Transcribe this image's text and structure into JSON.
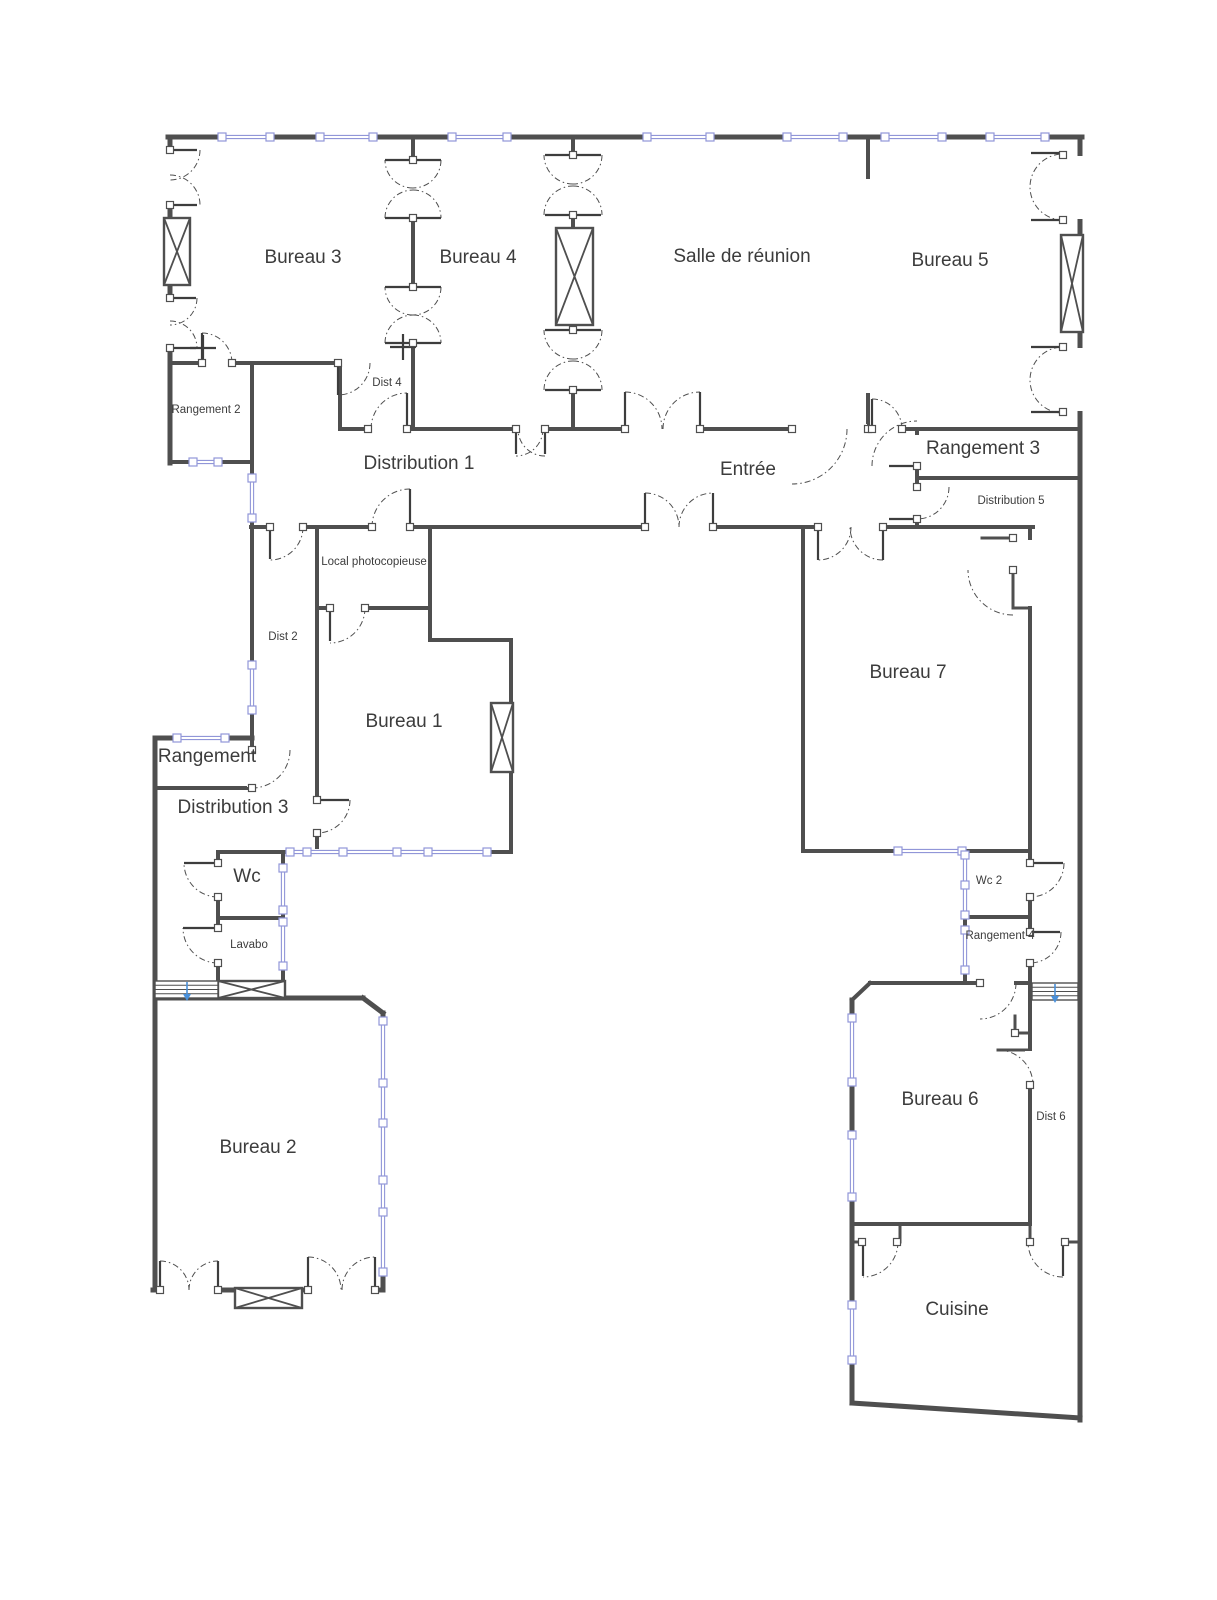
{
  "title": "Plan d'étage bureaux",
  "colors": {
    "background": "#ffffff",
    "wall": "#4f4f4f",
    "wall_thin": "#5a5a5a",
    "window": "#9196d8",
    "window_fill": "#ffffff",
    "door": "#4f4f4f",
    "label": "#3c3c3c",
    "stair_arrow": "#4a90d9"
  },
  "rooms": [
    {
      "id": "bureau-3",
      "label": "Bureau 3",
      "x": 303,
      "y": 258,
      "size": 19
    },
    {
      "id": "bureau-4",
      "label": "Bureau 4",
      "x": 478,
      "y": 258,
      "size": 19
    },
    {
      "id": "salle-de-reunion",
      "label": "Salle de réunion",
      "x": 742,
      "y": 257,
      "size": 19
    },
    {
      "id": "bureau-5",
      "label": "Bureau 5",
      "x": 950,
      "y": 261,
      "size": 19
    },
    {
      "id": "rangement-2",
      "label": "Rangement 2",
      "x": 206,
      "y": 410,
      "size": 11.5
    },
    {
      "id": "dist-4",
      "label": "Dist 4",
      "x": 387,
      "y": 383,
      "size": 11.5
    },
    {
      "id": "distribution-1",
      "label": "Distribution 1",
      "x": 419,
      "y": 464,
      "size": 19
    },
    {
      "id": "entree",
      "label": "Entrée",
      "x": 748,
      "y": 470,
      "size": 19
    },
    {
      "id": "rangement-3",
      "label": "Rangement 3",
      "x": 983,
      "y": 449,
      "size": 19
    },
    {
      "id": "distribution-5",
      "label": "Distribution 5",
      "x": 1011,
      "y": 501,
      "size": 11.5
    },
    {
      "id": "local-photocopieuse",
      "label": "Local photocopieuse",
      "x": 374,
      "y": 562,
      "size": 11.5
    },
    {
      "id": "dist-2",
      "label": "Dist 2",
      "x": 283,
      "y": 637,
      "size": 11.5
    },
    {
      "id": "bureau-1",
      "label": "Bureau 1",
      "x": 404,
      "y": 722,
      "size": 19
    },
    {
      "id": "bureau-7",
      "label": "Bureau 7",
      "x": 908,
      "y": 673,
      "size": 19
    },
    {
      "id": "rangement",
      "label": "Rangement",
      "x": 207,
      "y": 757,
      "size": 19
    },
    {
      "id": "distribution-3",
      "label": "Distribution 3",
      "x": 233,
      "y": 808,
      "size": 19
    },
    {
      "id": "wc",
      "label": "Wc",
      "x": 247,
      "y": 877,
      "size": 19
    },
    {
      "id": "lavabo",
      "label": "Lavabo",
      "x": 249,
      "y": 945,
      "size": 11.5
    },
    {
      "id": "wc-2",
      "label": "Wc 2",
      "x": 989,
      "y": 881,
      "size": 11.5
    },
    {
      "id": "rangement-4",
      "label": "Rangement 4",
      "x": 1000,
      "y": 936,
      "size": 11.5
    },
    {
      "id": "bureau-2",
      "label": "Bureau 2",
      "x": 258,
      "y": 1148,
      "size": 19
    },
    {
      "id": "bureau-6",
      "label": "Bureau 6",
      "x": 940,
      "y": 1100,
      "size": 19
    },
    {
      "id": "dist-6",
      "label": "Dist 6",
      "x": 1051,
      "y": 1117,
      "size": 11.5
    },
    {
      "id": "cuisine",
      "label": "Cuisine",
      "x": 957,
      "y": 1310,
      "size": 19
    }
  ],
  "walls": [
    [
      168,
      137,
      1082,
      137,
      5
    ],
    [
      1080,
      137,
      1080,
      1420,
      5
    ],
    [
      170,
      137,
      170,
      463,
      5
    ],
    [
      170,
      462,
      252,
      462,
      4
    ],
    [
      252,
      363,
      252,
      750,
      4
    ],
    [
      170,
      363,
      338,
      363,
      4
    ],
    [
      155,
      738,
      252,
      738,
      5
    ],
    [
      155,
      738,
      155,
      1290,
      5
    ],
    [
      155,
      788,
      252,
      788,
      4
    ],
    [
      340,
      363,
      340,
      429,
      4
    ],
    [
      413,
      137,
      413,
      429,
      4
    ],
    [
      573,
      137,
      573,
      429,
      4
    ],
    [
      868,
      137,
      868,
      177,
      4
    ],
    [
      868,
      395,
      868,
      429,
      4
    ],
    [
      340,
      429,
      1080,
      429,
      4
    ],
    [
      917,
      430,
      917,
      527,
      4
    ],
    [
      917,
      478,
      1080,
      478,
      4
    ],
    [
      251,
      527,
      1033,
      527,
      4
    ],
    [
      317,
      527,
      317,
      852,
      4
    ],
    [
      430,
      527,
      430,
      640,
      4
    ],
    [
      317,
      608,
      430,
      608,
      4
    ],
    [
      430,
      640,
      511,
      640,
      4
    ],
    [
      511,
      640,
      511,
      852,
      4
    ],
    [
      218,
      852,
      511,
      852,
      4
    ],
    [
      218,
      852,
      218,
      997,
      4
    ],
    [
      283,
      852,
      283,
      981,
      4
    ],
    [
      218,
      918,
      283,
      918,
      4
    ],
    [
      155,
      998,
      363,
      998,
      5
    ],
    [
      363,
      998,
      383,
      1013,
      5
    ],
    [
      383,
      1013,
      383,
      1290,
      5
    ],
    [
      153,
      1290,
      383,
      1290,
      5
    ],
    [
      803,
      527,
      803,
      851,
      4
    ],
    [
      803,
      851,
      1030,
      851,
      4
    ],
    [
      1030,
      527,
      1030,
      538,
      4
    ],
    [
      1030,
      608,
      1030,
      851,
      4
    ],
    [
      982,
      538,
      1013,
      538,
      3
    ],
    [
      1013,
      570,
      1013,
      608,
      3
    ],
    [
      1013,
      608,
      1030,
      608,
      3
    ],
    [
      965,
      851,
      965,
      983,
      4
    ],
    [
      965,
      917,
      1030,
      917,
      4
    ],
    [
      1030,
      851,
      1030,
      983,
      4
    ],
    [
      870,
      983,
      1030,
      983,
      4
    ],
    [
      870,
      983,
      852,
      1000,
      4
    ],
    [
      852,
      1000,
      852,
      1403,
      5
    ],
    [
      1030,
      983,
      1030,
      1224,
      4
    ],
    [
      1015,
      1016,
      1015,
      1033,
      3
    ],
    [
      1015,
      1033,
      1030,
      1033,
      3
    ],
    [
      998,
      1050,
      1030,
      1050,
      3
    ],
    [
      852,
      1224,
      1030,
      1224,
      4
    ],
    [
      900,
      1224,
      900,
      1242,
      3
    ],
    [
      1030,
      1224,
      1030,
      1242,
      3
    ],
    [
      852,
      1242,
      862,
      1242,
      3
    ],
    [
      1065,
      1242,
      1080,
      1242,
      3
    ],
    [
      852,
      1403,
      1080,
      1418,
      5
    ]
  ],
  "gaps": [
    [
      164,
      150,
      11,
      55
    ],
    [
      164,
      298,
      11,
      50
    ],
    [
      202,
      357,
      30,
      11
    ],
    [
      407,
      161,
      11,
      56
    ],
    [
      407,
      288,
      11,
      54
    ],
    [
      567,
      156,
      11,
      58
    ],
    [
      567,
      331,
      11,
      58
    ],
    [
      369,
      424,
      37,
      10
    ],
    [
      517,
      424,
      27,
      10
    ],
    [
      626,
      424,
      73,
      10
    ],
    [
      793,
      424,
      74,
      10
    ],
    [
      873,
      424,
      28,
      10
    ],
    [
      912,
      435,
      10,
      30
    ],
    [
      912,
      488,
      10,
      30
    ],
    [
      271,
      522,
      31,
      10
    ],
    [
      373,
      522,
      36,
      10
    ],
    [
      646,
      522,
      66,
      10
    ],
    [
      819,
      522,
      63,
      10
    ],
    [
      312,
      801,
      10,
      31
    ],
    [
      331,
      603,
      33,
      10
    ],
    [
      247,
      751,
      10,
      36
    ],
    [
      213,
      864,
      10,
      32
    ],
    [
      213,
      929,
      10,
      33
    ],
    [
      161,
      1284,
      56,
      11
    ],
    [
      309,
      1284,
      65,
      11
    ],
    [
      1025,
      864,
      10,
      32
    ],
    [
      1025,
      933,
      10,
      29
    ],
    [
      1025,
      1051,
      10,
      33
    ],
    [
      981,
      978,
      33,
      10
    ],
    [
      1074,
      156,
      11,
      63
    ],
    [
      1074,
      348,
      11,
      63
    ]
  ],
  "windows": [
    {
      "o": "h",
      "c": 137,
      "a": 222,
      "b": 270,
      "m": []
    },
    {
      "o": "h",
      "c": 137,
      "a": 320,
      "b": 373,
      "m": []
    },
    {
      "o": "h",
      "c": 137,
      "a": 452,
      "b": 507,
      "m": []
    },
    {
      "o": "h",
      "c": 137,
      "a": 647,
      "b": 710,
      "m": []
    },
    {
      "o": "h",
      "c": 137,
      "a": 787,
      "b": 843,
      "m": []
    },
    {
      "o": "h",
      "c": 137,
      "a": 885,
      "b": 942,
      "m": []
    },
    {
      "o": "h",
      "c": 137,
      "a": 990,
      "b": 1045,
      "m": []
    },
    {
      "o": "h",
      "c": 462,
      "a": 193,
      "b": 218,
      "m": []
    },
    {
      "o": "h",
      "c": 738,
      "a": 177,
      "b": 225,
      "m": []
    },
    {
      "o": "h",
      "c": 852,
      "a": 290,
      "b": 487,
      "m": [
        307,
        343,
        397,
        428
      ]
    },
    {
      "o": "h",
      "c": 851,
      "a": 898,
      "b": 962,
      "m": []
    },
    {
      "o": "v",
      "c": 252,
      "a": 478,
      "b": 518,
      "m": []
    },
    {
      "o": "v",
      "c": 252,
      "a": 665,
      "b": 710,
      "m": []
    },
    {
      "o": "v",
      "c": 283,
      "a": 868,
      "b": 910,
      "m": []
    },
    {
      "o": "v",
      "c": 283,
      "a": 922,
      "b": 966,
      "m": []
    },
    {
      "o": "v",
      "c": 383,
      "a": 1021,
      "b": 1272,
      "m": [
        1083,
        1123,
        1180,
        1212
      ]
    },
    {
      "o": "v",
      "c": 965,
      "a": 855,
      "b": 915,
      "m": [
        885
      ]
    },
    {
      "o": "v",
      "c": 965,
      "a": 930,
      "b": 970,
      "m": []
    },
    {
      "o": "v",
      "c": 852,
      "a": 1018,
      "b": 1082,
      "m": []
    },
    {
      "o": "v",
      "c": 852,
      "a": 1135,
      "b": 1197,
      "m": []
    },
    {
      "o": "v",
      "c": 852,
      "a": 1305,
      "b": 1360,
      "m": []
    }
  ],
  "doors": [
    [
      170,
      150,
      30,
      0,
      90
    ],
    [
      170,
      205,
      30,
      -90,
      0
    ],
    [
      170,
      298,
      27,
      0,
      90
    ],
    [
      170,
      348,
      27,
      -90,
      0
    ],
    [
      202,
      363,
      30,
      -90,
      0
    ],
    [
      338,
      363,
      32,
      0,
      90
    ],
    [
      413,
      160,
      28,
      90,
      180
    ],
    [
      413,
      218,
      28,
      180,
      270
    ],
    [
      413,
      160,
      28,
      0,
      90
    ],
    [
      413,
      218,
      28,
      -90,
      0
    ],
    [
      413,
      287,
      28,
      90,
      180
    ],
    [
      413,
      343,
      28,
      180,
      270
    ],
    [
      413,
      287,
      28,
      0,
      90
    ],
    [
      413,
      343,
      28,
      -90,
      0
    ],
    [
      573,
      155,
      29,
      90,
      180
    ],
    [
      573,
      215,
      29,
      180,
      270
    ],
    [
      573,
      155,
      29,
      0,
      90
    ],
    [
      573,
      215,
      29,
      -90,
      0
    ],
    [
      573,
      330,
      29,
      90,
      180
    ],
    [
      573,
      390,
      29,
      180,
      270
    ],
    [
      573,
      330,
      29,
      0,
      90
    ],
    [
      573,
      390,
      29,
      -90,
      0
    ],
    [
      516,
      429,
      27,
      0,
      90
    ],
    [
      545,
      429,
      27,
      90,
      180
    ],
    [
      625,
      429,
      37,
      -90,
      0
    ],
    [
      700,
      429,
      37,
      180,
      270
    ],
    [
      792,
      429,
      55,
      0,
      90
    ],
    [
      872,
      429,
      30,
      -90,
      0
    ],
    [
      407,
      429,
      36,
      180,
      270
    ],
    [
      917,
      466,
      45,
      180,
      270
    ],
    [
      917,
      487,
      32,
      0,
      90
    ],
    [
      270,
      527,
      33,
      0,
      90
    ],
    [
      410,
      527,
      38,
      180,
      270
    ],
    [
      645,
      527,
      34,
      -90,
      0
    ],
    [
      713,
      527,
      34,
      180,
      270
    ],
    [
      818,
      527,
      33,
      0,
      90
    ],
    [
      883,
      527,
      33,
      90,
      180
    ],
    [
      1013,
      570,
      45,
      90,
      180
    ],
    [
      330,
      608,
      35,
      0,
      90
    ],
    [
      317,
      800,
      33,
      0,
      90
    ],
    [
      252,
      750,
      38,
      0,
      90
    ],
    [
      218,
      863,
      34,
      90,
      180
    ],
    [
      218,
      928,
      35,
      90,
      180
    ],
    [
      160,
      1290,
      29,
      -90,
      0
    ],
    [
      218,
      1290,
      29,
      180,
      270
    ],
    [
      308,
      1290,
      33,
      -90,
      0
    ],
    [
      375,
      1290,
      33,
      180,
      270
    ],
    [
      1030,
      863,
      34,
      0,
      90
    ],
    [
      1030,
      932,
      31,
      0,
      90
    ],
    [
      980,
      983,
      36,
      0,
      90
    ],
    [
      998,
      1085,
      35,
      -90,
      0
    ],
    [
      863,
      1242,
      35,
      0,
      90
    ],
    [
      1063,
      1242,
      35,
      90,
      180
    ],
    [
      1063,
      187,
      33,
      90,
      270
    ],
    [
      1063,
      380,
      33,
      90,
      270
    ]
  ],
  "leaves": [
    [
      170,
      150,
      197,
      150
    ],
    [
      170,
      205,
      197,
      205
    ],
    [
      170,
      298,
      196,
      298
    ],
    [
      170,
      348,
      196,
      348
    ],
    [
      385,
      160,
      441,
      160
    ],
    [
      385,
      218,
      441,
      218
    ],
    [
      385,
      287,
      441,
      287
    ],
    [
      385,
      343,
      441,
      343
    ],
    [
      545,
      155,
      601,
      155
    ],
    [
      545,
      215,
      601,
      215
    ],
    [
      545,
      330,
      601,
      330
    ],
    [
      545,
      390,
      601,
      390
    ],
    [
      625,
      392,
      625,
      429
    ],
    [
      700,
      392,
      700,
      429
    ],
    [
      516,
      429,
      516,
      454
    ],
    [
      545,
      429,
      545,
      454
    ],
    [
      202,
      333,
      202,
      363
    ],
    [
      338,
      363,
      338,
      395
    ],
    [
      407,
      393,
      407,
      429
    ],
    [
      645,
      493,
      645,
      527
    ],
    [
      713,
      493,
      713,
      527
    ],
    [
      818,
      527,
      818,
      560
    ],
    [
      883,
      527,
      883,
      560
    ],
    [
      889,
      466,
      917,
      466
    ],
    [
      889,
      519,
      917,
      519
    ],
    [
      270,
      527,
      270,
      559
    ],
    [
      410,
      489,
      410,
      527
    ],
    [
      330,
      608,
      330,
      641
    ],
    [
      317,
      800,
      349,
      800
    ],
    [
      184,
      863,
      218,
      863
    ],
    [
      183,
      928,
      218,
      928
    ],
    [
      160,
      1261,
      160,
      1290
    ],
    [
      218,
      1261,
      218,
      1290
    ],
    [
      308,
      1257,
      308,
      1290
    ],
    [
      375,
      1257,
      375,
      1290
    ],
    [
      1030,
      863,
      1063,
      863
    ],
    [
      1030,
      932,
      1060,
      932
    ],
    [
      863,
      1242,
      863,
      1276
    ],
    [
      1063,
      1242,
      1063,
      1276
    ],
    [
      1031,
      153,
      1063,
      153
    ],
    [
      1031,
      220,
      1063,
      220
    ],
    [
      1031,
      347,
      1063,
      347
    ],
    [
      1031,
      412,
      1063,
      412
    ],
    [
      190,
      348,
      216,
      348
    ],
    [
      203,
      335,
      203,
      361
    ],
    [
      390,
      347,
      416,
      347
    ],
    [
      403,
      334,
      403,
      360
    ],
    [
      872,
      399,
      872,
      429
    ]
  ],
  "jambs": [
    [
      170,
      150
    ],
    [
      170,
      205
    ],
    [
      170,
      298
    ],
    [
      170,
      348
    ],
    [
      202,
      363
    ],
    [
      232,
      363
    ],
    [
      338,
      363
    ],
    [
      413,
      160
    ],
    [
      413,
      218
    ],
    [
      413,
      287
    ],
    [
      413,
      343
    ],
    [
      573,
      155
    ],
    [
      573,
      215
    ],
    [
      573,
      330
    ],
    [
      573,
      390
    ],
    [
      516,
      429
    ],
    [
      545,
      429
    ],
    [
      625,
      429
    ],
    [
      700,
      429
    ],
    [
      792,
      429
    ],
    [
      868,
      429
    ],
    [
      872,
      429
    ],
    [
      902,
      429
    ],
    [
      368,
      429
    ],
    [
      407,
      429
    ],
    [
      917,
      466
    ],
    [
      917,
      487
    ],
    [
      917,
      519
    ],
    [
      270,
      527
    ],
    [
      303,
      527
    ],
    [
      372,
      527
    ],
    [
      410,
      527
    ],
    [
      645,
      527
    ],
    [
      713,
      527
    ],
    [
      818,
      527
    ],
    [
      883,
      527
    ],
    [
      1013,
      538
    ],
    [
      1013,
      570
    ],
    [
      330,
      608
    ],
    [
      365,
      608
    ],
    [
      317,
      800
    ],
    [
      317,
      833
    ],
    [
      252,
      750
    ],
    [
      252,
      788
    ],
    [
      218,
      863
    ],
    [
      218,
      897
    ],
    [
      218,
      928
    ],
    [
      218,
      963
    ],
    [
      160,
      1290
    ],
    [
      218,
      1290
    ],
    [
      308,
      1290
    ],
    [
      375,
      1290
    ],
    [
      1030,
      863
    ],
    [
      1030,
      897
    ],
    [
      1030,
      932
    ],
    [
      1030,
      963
    ],
    [
      980,
      983
    ],
    [
      1015,
      1033
    ],
    [
      1030,
      1085
    ],
    [
      862,
      1242
    ],
    [
      897,
      1242
    ],
    [
      1030,
      1242
    ],
    [
      1065,
      1242
    ],
    [
      1063,
      155
    ],
    [
      1063,
      220
    ],
    [
      1063,
      347
    ],
    [
      1063,
      412
    ]
  ],
  "shafts": [
    [
      164,
      218,
      26,
      67
    ],
    [
      556,
      228,
      37,
      97
    ],
    [
      1061,
      235,
      22,
      97
    ],
    [
      491,
      703,
      22,
      69
    ],
    [
      218,
      981,
      67,
      17
    ],
    [
      235,
      1288,
      67,
      20
    ]
  ],
  "stairs": [
    {
      "x": 155,
      "y": 981,
      "w": 63,
      "h": 17,
      "arrow_x": 187
    },
    {
      "x": 1032,
      "y": 983,
      "w": 46,
      "h": 17,
      "arrow_x": 1055
    }
  ],
  "canvas": {
    "width": 1217,
    "height": 1600
  }
}
